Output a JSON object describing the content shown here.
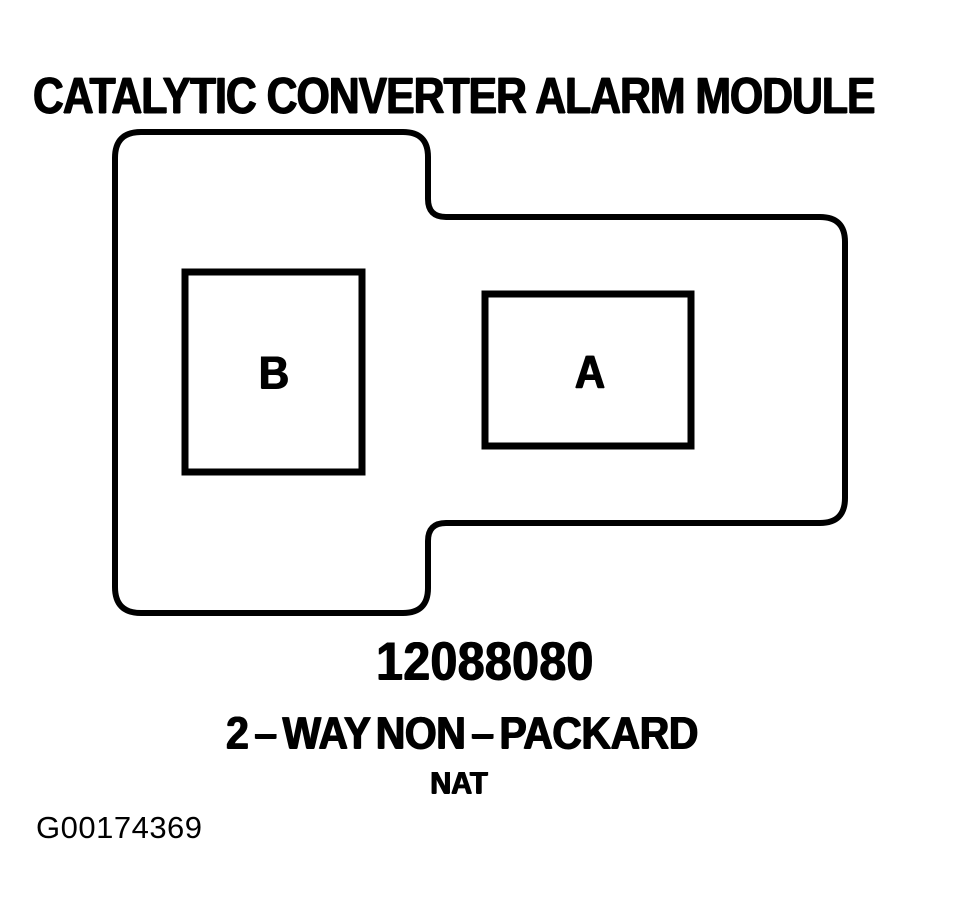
{
  "colors": {
    "ink": "#000000",
    "background": "#ffffff"
  },
  "header": {
    "title": "CATALYTIC CONVERTER ALARM MODULE"
  },
  "connector": {
    "cavities": [
      {
        "label": "B"
      },
      {
        "label": "A"
      }
    ],
    "part_number": "12088080",
    "type_label": "2 – WAY NON – PACKARD",
    "material_code": "NAT"
  },
  "footer": {
    "figure_id": "G00174369"
  }
}
